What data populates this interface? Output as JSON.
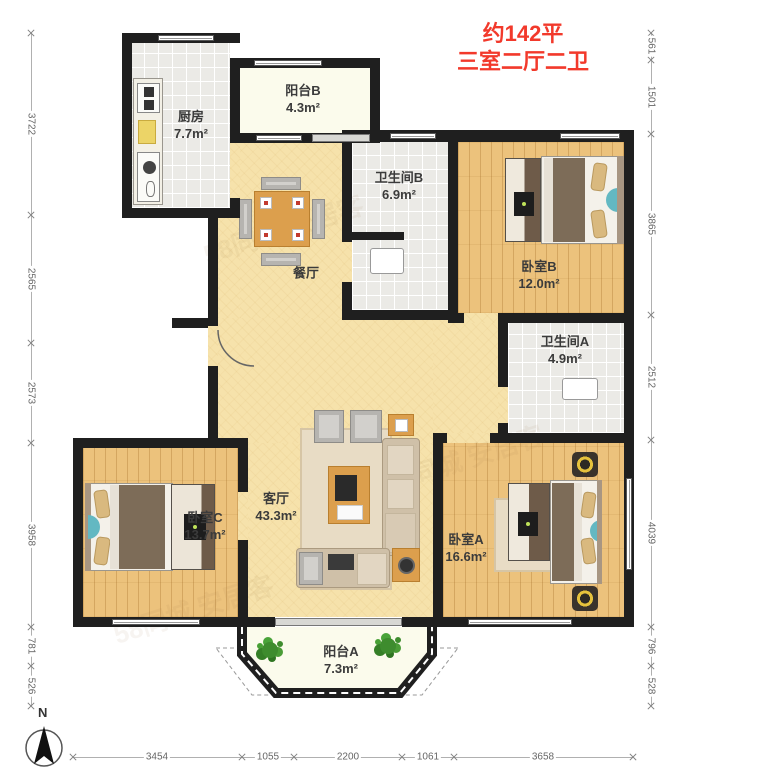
{
  "title": {
    "line1": "约142平",
    "line2": "三室二厅二卫"
  },
  "compass": {
    "north_label": "N"
  },
  "rooms": {
    "kitchen": {
      "name": "厨房",
      "area": "7.7m²"
    },
    "balcony_b": {
      "name": "阳台B",
      "area": "4.3m²"
    },
    "bath_b": {
      "name": "卫生间B",
      "area": "6.9m²"
    },
    "bedroom_b": {
      "name": "卧室B",
      "area": "12.0m²"
    },
    "dining": {
      "name": "餐厅",
      "area": ""
    },
    "bath_a": {
      "name": "卫生间A",
      "area": "4.9m²"
    },
    "living": {
      "name": "客厅",
      "area": "43.3m²"
    },
    "bedroom_c": {
      "name": "卧室C",
      "area": "13.7m²"
    },
    "bedroom_a": {
      "name": "卧室A",
      "area": "16.6m²"
    },
    "balcony_a": {
      "name": "阳台A",
      "area": "7.3m²"
    }
  },
  "dimensions_mm": {
    "left": [
      "3722",
      "2565",
      "2573",
      "3958",
      "781",
      "526"
    ],
    "right": [
      "561",
      "1501",
      "3865",
      "2512",
      "4039",
      "796",
      "528"
    ],
    "bottom": [
      "3454",
      "1055",
      "2200",
      "1061",
      "3658"
    ]
  },
  "watermark": {
    "text": "58同城 安居客"
  },
  "colors": {
    "accent_red": "#f2392b",
    "wall": "#1f1f1f",
    "floor_wood": "#ecc27c",
    "floor_tile": "#ebeae6",
    "floor_main": "#f6e2ab",
    "floor_balcony": "#fbfbec",
    "plant_green": "#3e8c2e",
    "teal_accent": "#63b8c2",
    "dimension_text": "#666666"
  }
}
